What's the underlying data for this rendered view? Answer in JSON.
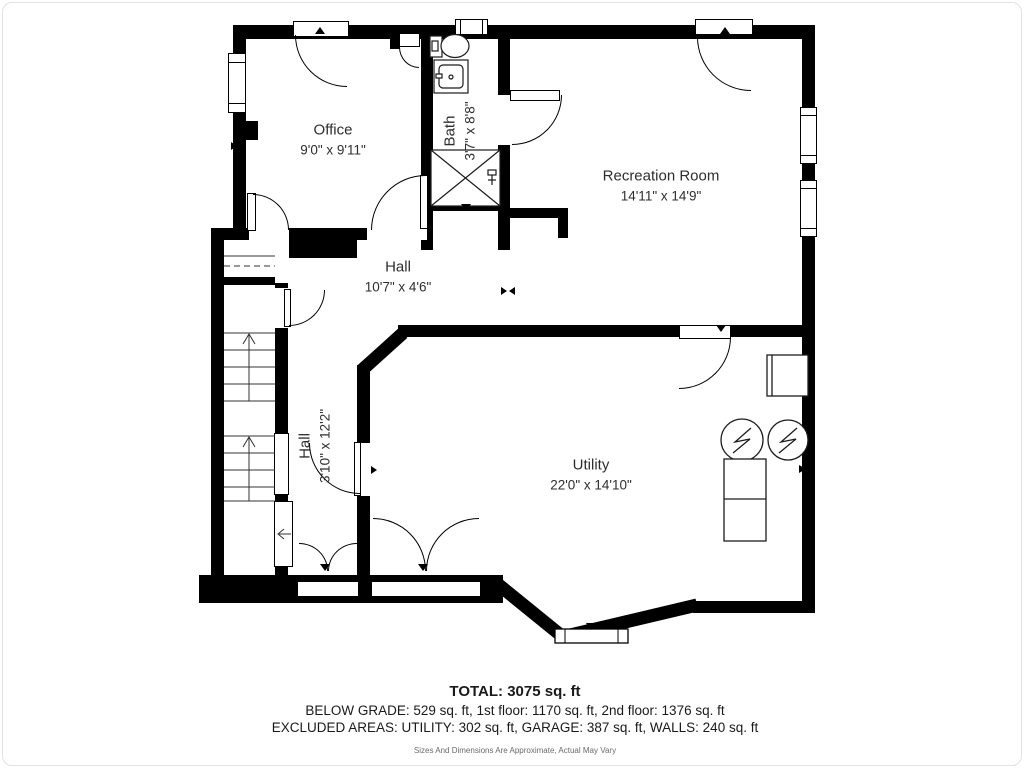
{
  "rooms": {
    "office": {
      "name": "Office",
      "dims": "9'0\" x 9'11\""
    },
    "bath": {
      "name": "Bath",
      "dims": "3'7\" x 8'8\""
    },
    "recreation": {
      "name": "Recreation Room",
      "dims": "14'11\" x 14'9\""
    },
    "hall": {
      "name": "Hall",
      "dims": "10'7\" x 4'6\""
    },
    "hall2": {
      "name": "Hall",
      "dims": "3'10\" x 12'2\""
    },
    "utility": {
      "name": "Utility",
      "dims": "22'0\" x 14'10\""
    }
  },
  "footer": {
    "total": "TOTAL: 3075 sq. ft",
    "line2": "BELOW GRADE: 529 sq. ft, 1st floor: 1170 sq. ft, 2nd floor: 1376 sq. ft",
    "line3": "EXCLUDED AREAS: UTILITY: 302 sq. ft, GARAGE: 387 sq. ft, WALLS: 240 sq. ft",
    "disclaimer": "Sizes And Dimensions Are Approximate, Actual May Vary"
  },
  "colors": {
    "wall": "#000000",
    "linework": "#1c1c1c",
    "background": "#ffffff",
    "label": "#2e2e2e"
  }
}
